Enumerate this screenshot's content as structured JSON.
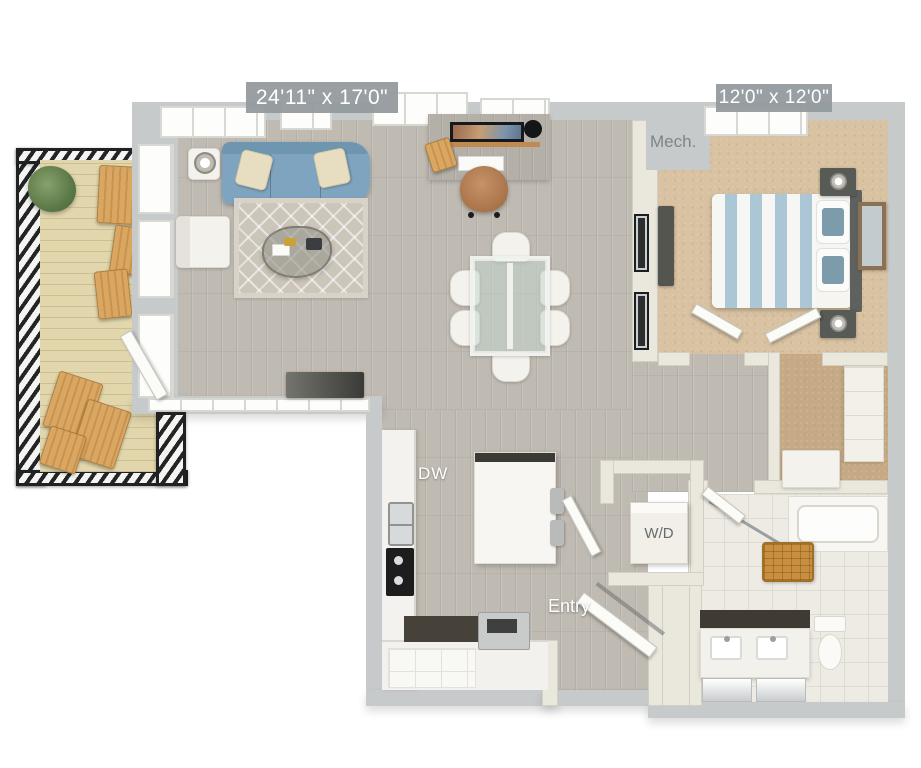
{
  "floor_plan": {
    "rooms": {
      "living_dining": {
        "dimensions": "24'11\" x 17'0\""
      },
      "bedroom": {
        "dimensions": "12'0\" x 12'0\""
      },
      "mech": {
        "label": "Mech."
      },
      "entry": {
        "label": "Entry"
      }
    },
    "appliances": {
      "dishwasher": "DW",
      "washer_dryer": "W/D"
    },
    "colors": {
      "exterior_wall": "#c7cacb",
      "interior_wall": "#eae7dc",
      "wood_floor": "#c0bbb2",
      "deck_wood": "#e1d6ac",
      "bedroom_carpet": "#d8c2a2",
      "closet_carpet": "#c6aa85",
      "sofa_blue": "#7fa4bf",
      "bedding_blue": "#abc6d5",
      "railing_black": "#222426",
      "basket_orange": "#c98f3f",
      "dimension_label_bg": "#939a9e",
      "dimension_label_text": "#ffffff"
    }
  }
}
